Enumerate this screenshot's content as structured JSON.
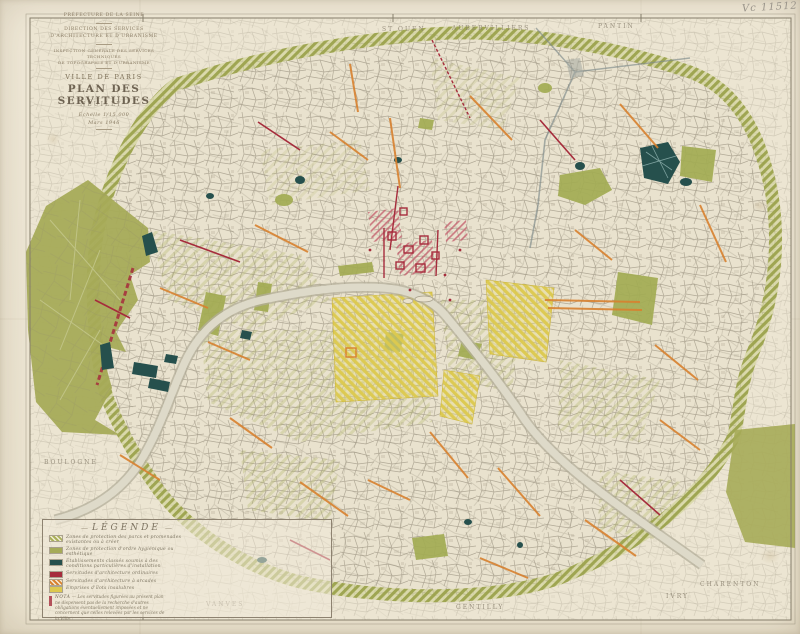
{
  "annotation": {
    "text": "Vc 11512"
  },
  "title_block": {
    "line1": "PRÉFECTURE DE LA SEINE",
    "line2": "DIRECTION DES SERVICES",
    "line3": "D'ARCHITECTURE ET D'URBANISME",
    "line4": "INSPECTION GÉNÉRALE DES SERVICES TECHNIQUES",
    "line5": "DE TOPOGRAPHIE ET D'URBANISME",
    "city": "VILLE DE PARIS",
    "title": "PLAN DES SERVITUDES",
    "scale": "Échelle 1/15.000",
    "date": "Mars 1946"
  },
  "legend": {
    "title": "LÉGENDE",
    "items": [
      {
        "label": "Zones de protection des parcs et promenades existantes ou à créer",
        "color": "#aab05a"
      },
      {
        "label": "Zones de protection d'ordre hygiénique ou esthétique",
        "color": "#a6ab58"
      },
      {
        "label": "Établissements classés soumis à des conditions particulières d'installation",
        "color": "#26504d"
      },
      {
        "label": "Servitudes d'architecture ordinaires",
        "color": "#a62c3c"
      },
      {
        "label": "Servitudes d'architecture à arcades",
        "color": "#d8812f"
      },
      {
        "label": "Emprises d'îlots insalubres",
        "color": "#ddc84e"
      }
    ],
    "nota_word": "NOTA",
    "nota_text": " — Les servitudes figurées au présent plan ne dispensent pas de la recherche d'autres obligations éventuellement imposées et ne concernent que celles relevées par les services de la Ville."
  },
  "map": {
    "labels": [
      {
        "text": "ST OUEN"
      },
      {
        "text": "AUBERVILLIERS"
      },
      {
        "text": "PANTIN"
      },
      {
        "text": "NEUILLY"
      },
      {
        "text": "BOULOGNE"
      },
      {
        "text": "VANVES"
      },
      {
        "text": "GENTILLY"
      },
      {
        "text": "IVRY"
      },
      {
        "text": "CHARENTON"
      }
    ]
  },
  "palette": {
    "paper": "#f1ead9",
    "map_base": "#eae3d0",
    "street_gray": "#8b8371",
    "olive_green": "#a6ab58",
    "teal": "#26504d",
    "servitude_red": "#a62c3c",
    "servitude_orange": "#d8812f",
    "insalubre_yellow": "#ddc84e",
    "river": "#dedac9"
  }
}
